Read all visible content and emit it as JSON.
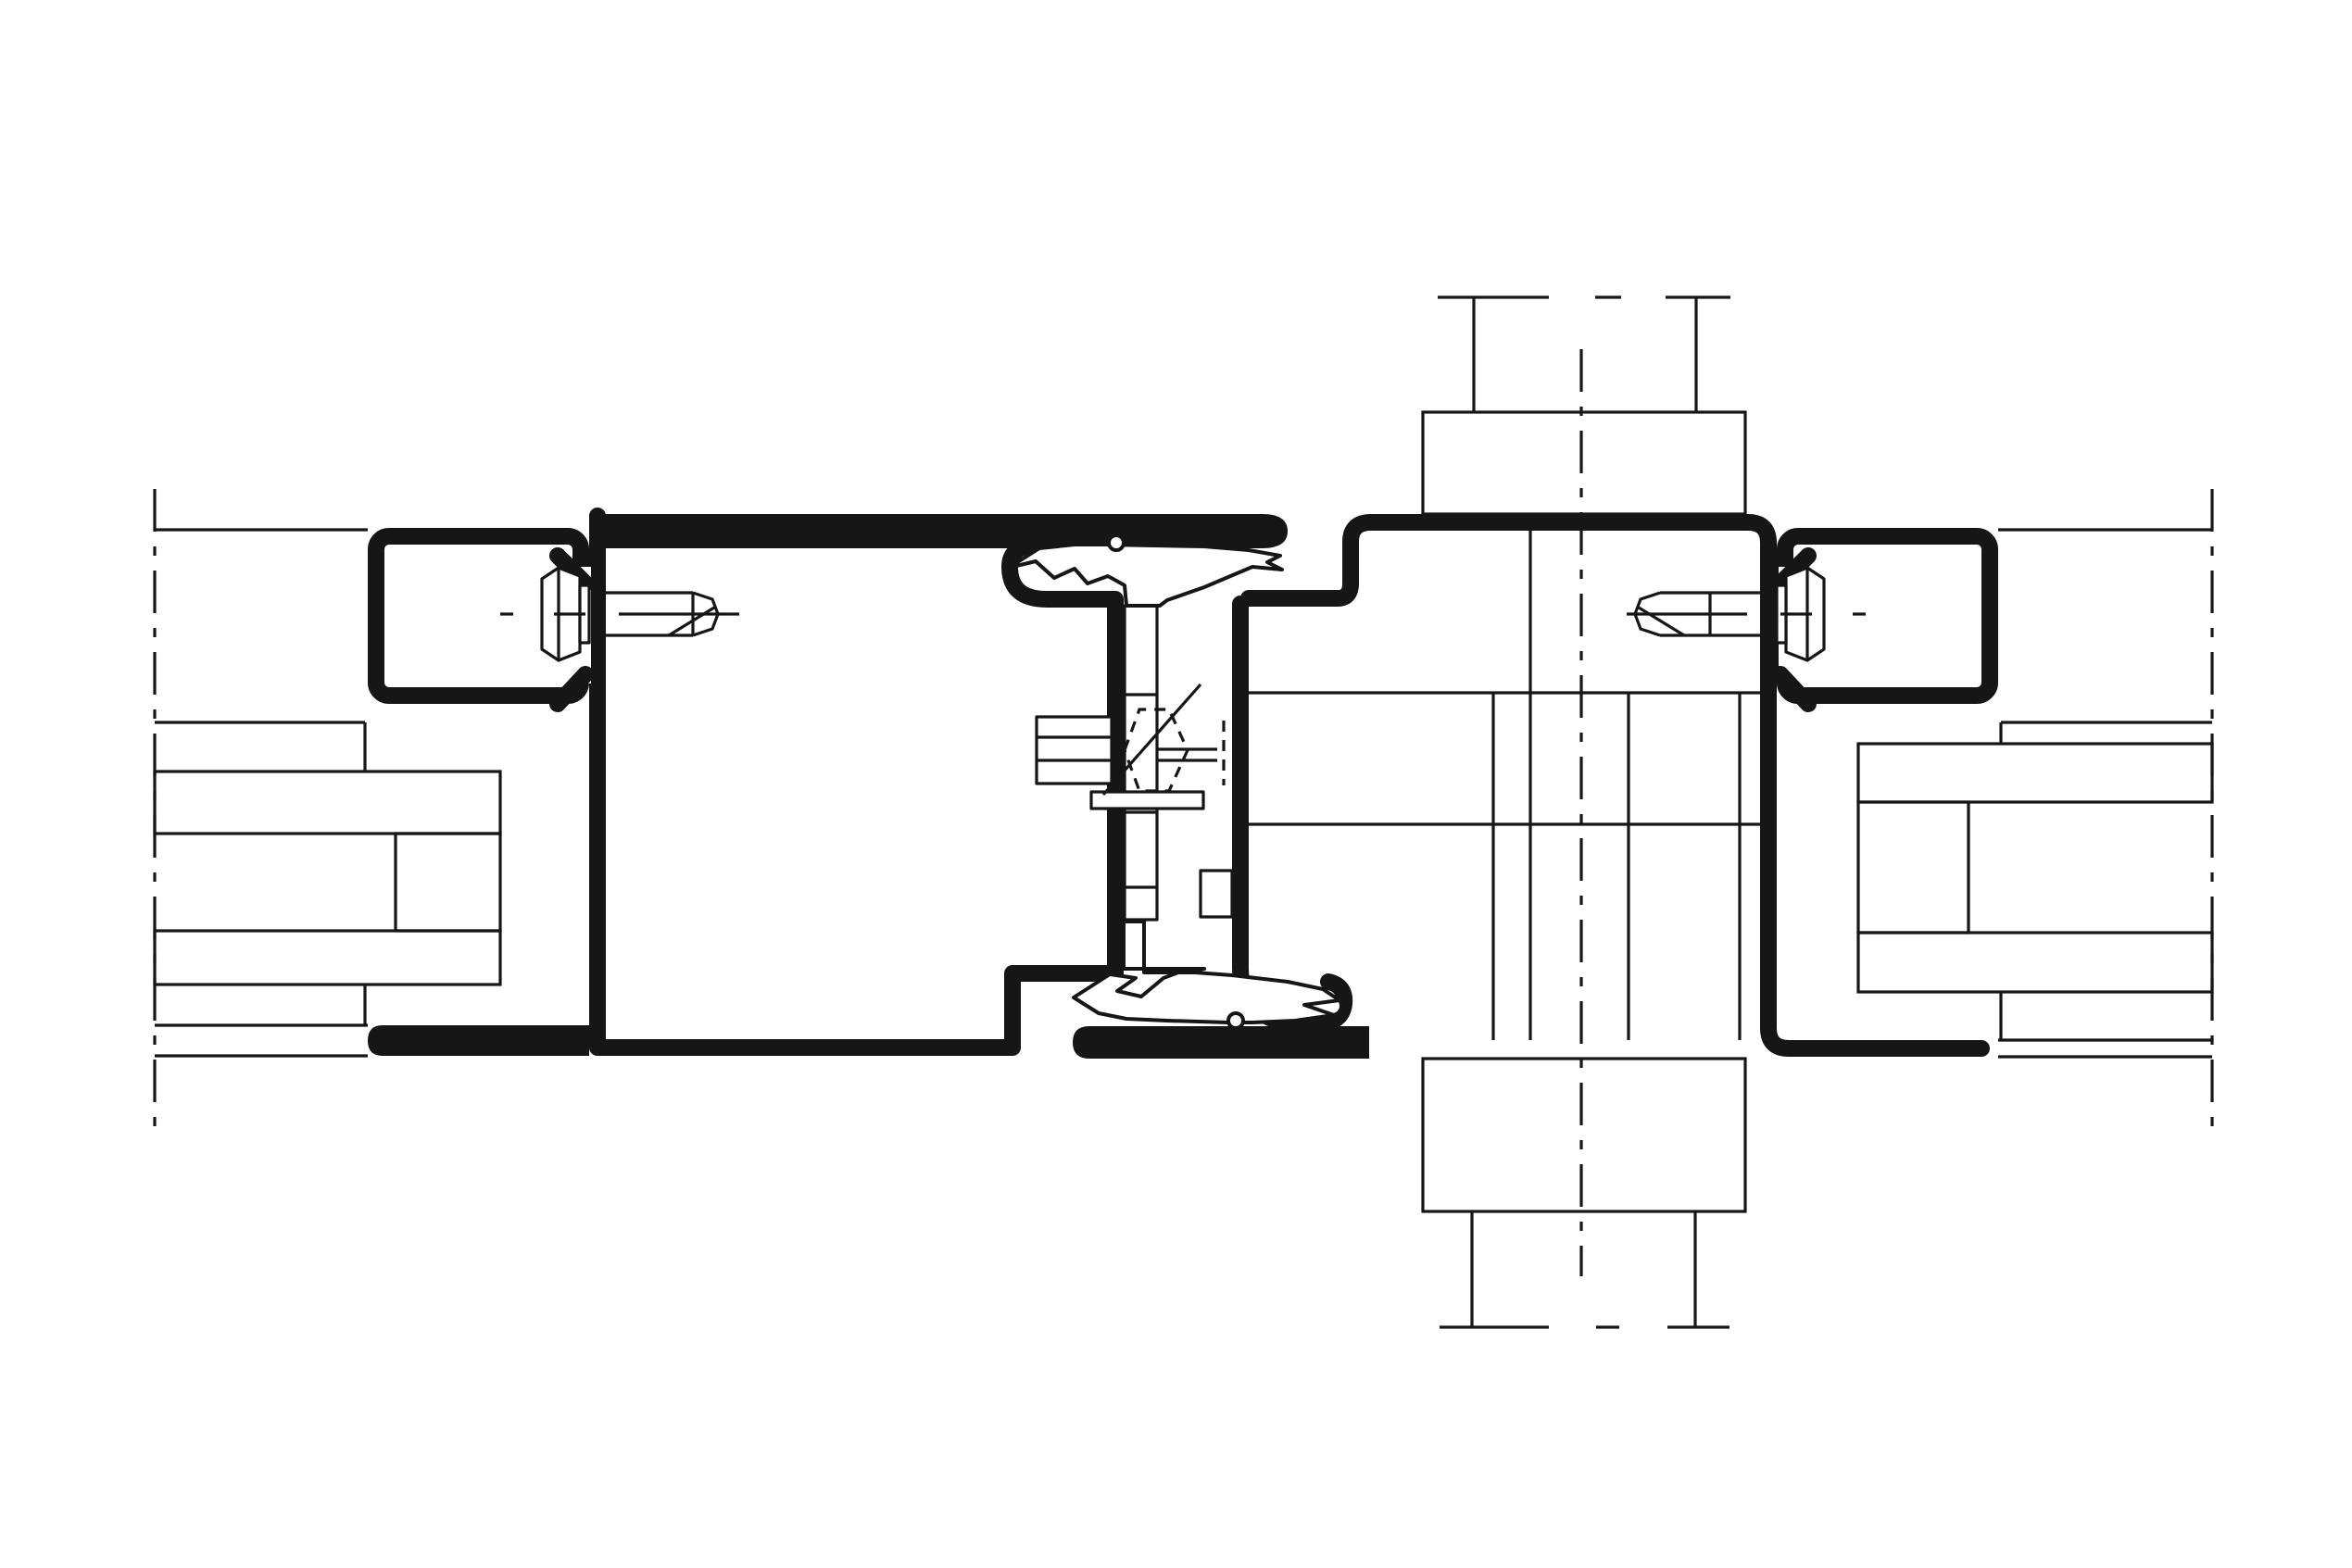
{
  "drawing": {
    "kind": "technical-cad-section",
    "subject": "horizontal section detail of a metal window/facade joint: vent profile and frame profile with central gaskets, clamp glazing beads, fixing screws, hidden connection bolt and insulated glazing units",
    "text_labels": []
  },
  "colors": {
    "paper": "#ffffff",
    "ink": "#161616",
    "glass": "#c6ded9",
    "glass_spacer": "#e9f3ef"
  },
  "components": {
    "left_boundary": "section-break-line-left",
    "right_boundary": "section-break-line-right",
    "center_axis": "mullion-centerline",
    "top_connection": "adjacent-member-above",
    "bottom_connection": "adjacent-member-below",
    "left_glazing": "insulated-glass-unit-left",
    "right_glazing": "insulated-glass-unit-right",
    "left_profile": "vent-profile",
    "right_profile": "frame-profile",
    "left_bead": "glazing-bead-left",
    "right_bead": "glazing-bead-right",
    "left_screw": "fixing-screw-left",
    "right_screw": "fixing-screw-right",
    "top_gasket": "center-gasket-top",
    "bottom_gasket": "center-gasket-bottom",
    "bolt": "hidden-connection-bolt",
    "cover_band": "bottom-cover-profile"
  }
}
